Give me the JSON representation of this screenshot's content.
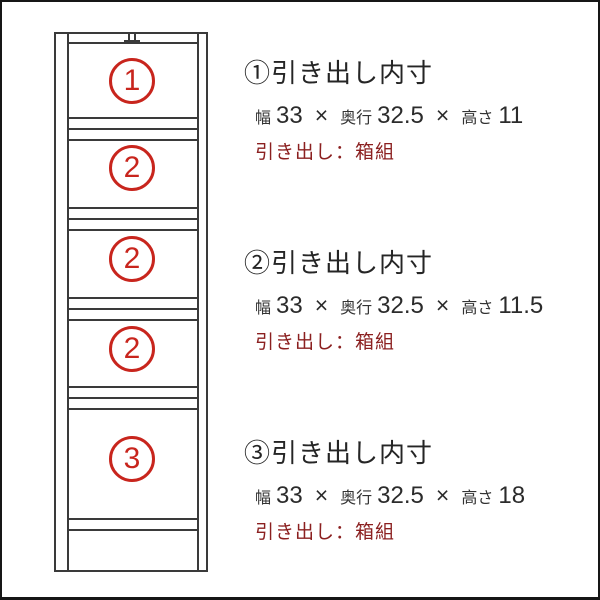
{
  "diagram": {
    "compartments": [
      {
        "number": "1"
      },
      {
        "number": "2"
      },
      {
        "number": "2"
      },
      {
        "number": "2"
      },
      {
        "number": "3"
      }
    ]
  },
  "specs": [
    {
      "heading": "①引き出し内寸",
      "width_label": "幅",
      "width_value": "33",
      "times": "×",
      "depth_label": "奥行",
      "depth_value": "32.5",
      "height_label": "高さ",
      "height_value": "11",
      "note": "引き出し：箱組"
    },
    {
      "heading": "②引き出し内寸",
      "width_label": "幅",
      "width_value": "33",
      "times": "×",
      "depth_label": "奥行",
      "depth_value": "32.5",
      "height_label": "高さ",
      "height_value": "11.5",
      "note": "引き出し：箱組"
    },
    {
      "heading": "③引き出し内寸",
      "width_label": "幅",
      "width_value": "33",
      "times": "×",
      "depth_label": "奥行",
      "depth_value": "32.5",
      "height_label": "高さ",
      "height_value": "18",
      "note": "引き出し：箱組"
    }
  ],
  "colors": {
    "circle_red": "#c8251d",
    "note_red": "#8b2020",
    "line_gray": "#3a3a3a",
    "text_black": "#252525"
  }
}
